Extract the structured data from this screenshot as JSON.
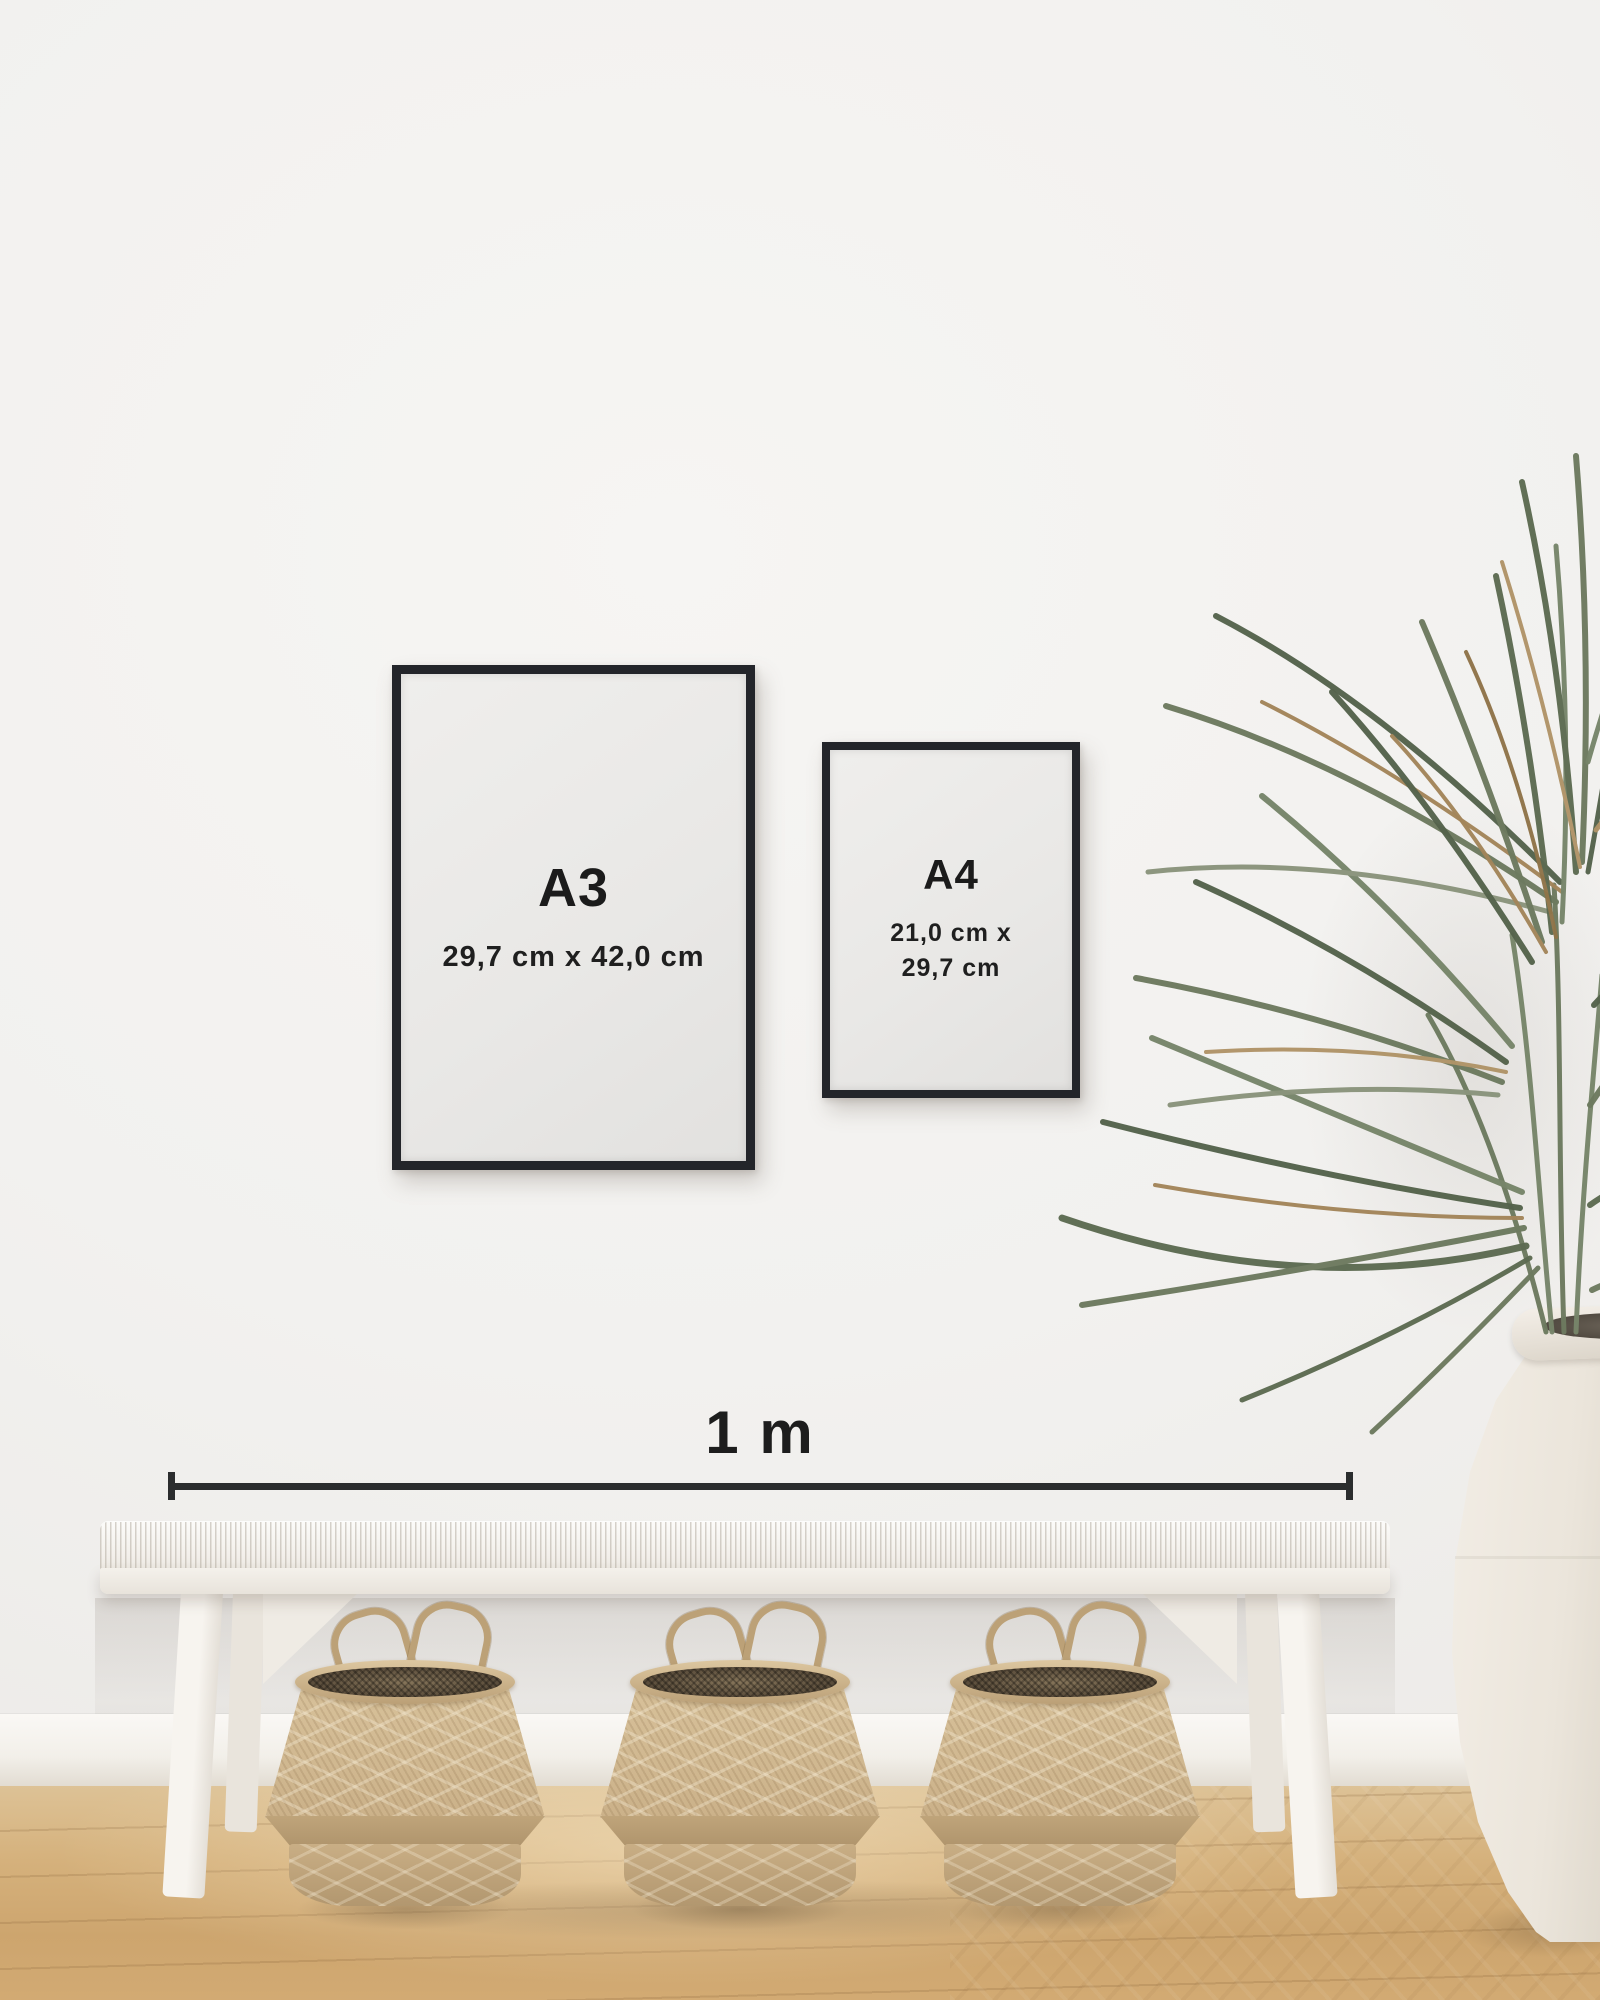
{
  "scene": {
    "description": "Poster size comparison mockup: A3 and A4 black frames on a white wall above a white woven bench with three seagrass belly baskets, a dried palm in a white ceramic urn, wooden floor",
    "colors": {
      "wall": "#f2f1ef",
      "frame_border": "#23252a",
      "poster_paper": "#e9e8e6",
      "text": "#1b1b1b",
      "measure_line": "#2b2d2e",
      "floor_wood": "#d2aa73",
      "bench_white": "#f3f0eb",
      "basket_tan": "#cbb189",
      "plant_green": "#5d6b52",
      "plant_brown": "#a3855a",
      "vase_white": "#ebe5db"
    }
  },
  "frames": {
    "a3": {
      "label": "A3",
      "dimensions": "29,7 cm x 42,0 cm"
    },
    "a4": {
      "label": "A4",
      "dimensions_line1": "21,0 cm x",
      "dimensions_line2": "29,7 cm"
    }
  },
  "scale_bar": {
    "label": "1 m"
  }
}
